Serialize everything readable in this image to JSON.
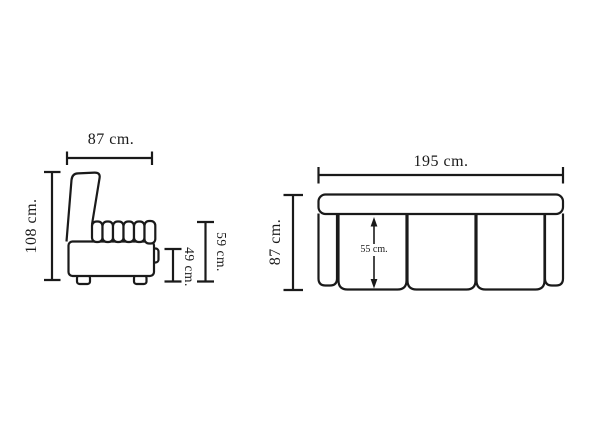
{
  "colors": {
    "line": "#1a1a1a",
    "background": "#ffffff"
  },
  "side_view": {
    "width_label": "87 cm.",
    "height_label": "108 cm.",
    "back_height_label": "59 cm.",
    "seat_height_label": "49 cm."
  },
  "front_view": {
    "width_label": "195 cm.",
    "height_label": "87 cm.",
    "seat_depth_label": "55 cm."
  }
}
